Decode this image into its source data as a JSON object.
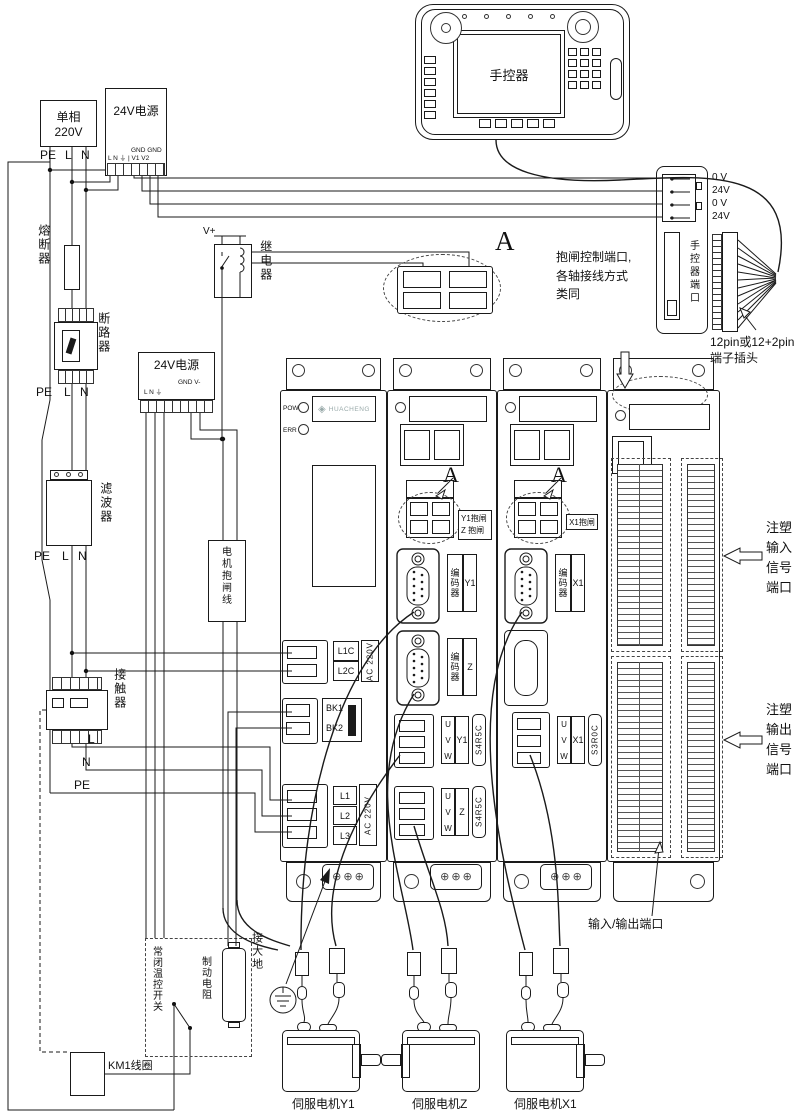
{
  "pendant": {
    "screen": "手控器"
  },
  "mains": {
    "l1": "单相",
    "l2": "220V"
  },
  "pe_l_n": [
    "PE",
    "L",
    "N"
  ],
  "psu1": {
    "title": "24V电源",
    "gnd": "GND GND",
    "pins": "L N ⏚ | V1 V2"
  },
  "psu2": {
    "title": "24V电源",
    "out": "GND V-",
    "pins": "L N ⏚"
  },
  "fuse": {
    "label": "熔断器"
  },
  "breaker": {
    "label": "断路器"
  },
  "filter": {
    "label": "滤波器"
  },
  "contactor": {
    "label": "接触器"
  },
  "bus": [
    "L",
    "N",
    "PE"
  ],
  "relay": {
    "label": "继电器",
    "vplus": "V+"
  },
  "brake_cable_box": {
    "label": "电机抱闸线"
  },
  "detailA": {
    "marker": "A",
    "note": [
      "抱闸控制端口,",
      "各轴接线方式",
      "类同"
    ]
  },
  "port": {
    "pins": [
      "0 V",
      "24V",
      "0 V",
      "24V"
    ],
    "label": "手控器端口",
    "plug": [
      "12pin或12+2pin",
      "端子插头"
    ]
  },
  "m1": {
    "pow": "POW",
    "err": "ERR",
    "brand": "HUACHENG",
    "ctrl": [
      "L1C",
      "L2C"
    ],
    "ctrl_v": "AC 220V",
    "bk": [
      "BK1",
      "BK2"
    ],
    "mains_t": [
      "L1",
      "L2",
      "L3"
    ],
    "mains_v": "AC 220V"
  },
  "m2": {
    "marker": "A",
    "brake": [
      "Y1抱闸",
      "Z 抱闸"
    ],
    "enc1": {
      "name": "编码器",
      "axis": "Y1"
    },
    "enc2": {
      "name": "编码器",
      "axis": "Z"
    },
    "pwr1": {
      "u": "U",
      "v": "V",
      "w": "W",
      "axis": "Y1",
      "model": "S4R5C"
    },
    "pwr2": {
      "u": "U",
      "v": "V",
      "w": "W",
      "axis": "Z",
      "model": "S4R5C"
    }
  },
  "m3": {
    "marker": "A",
    "brake": "X1抱闸",
    "enc1": {
      "name": "编码器",
      "axis": "X1"
    },
    "pwr1": {
      "u": "U",
      "v": "V",
      "w": "W",
      "axis": "X1",
      "model": "S3R0C"
    }
  },
  "m4": {
    "in_label": "注塑输入信号端口",
    "out_label": "注塑输出信号端口",
    "io_label": "输入/输出端口"
  },
  "bottom": {
    "earth": "接大地",
    "resistor": "制动电阻",
    "thermal": "常闭温控开关",
    "km1": "KM1线圈"
  },
  "motors": [
    "伺服电机Y1",
    "伺服电机Z",
    "伺服电机X1"
  ]
}
